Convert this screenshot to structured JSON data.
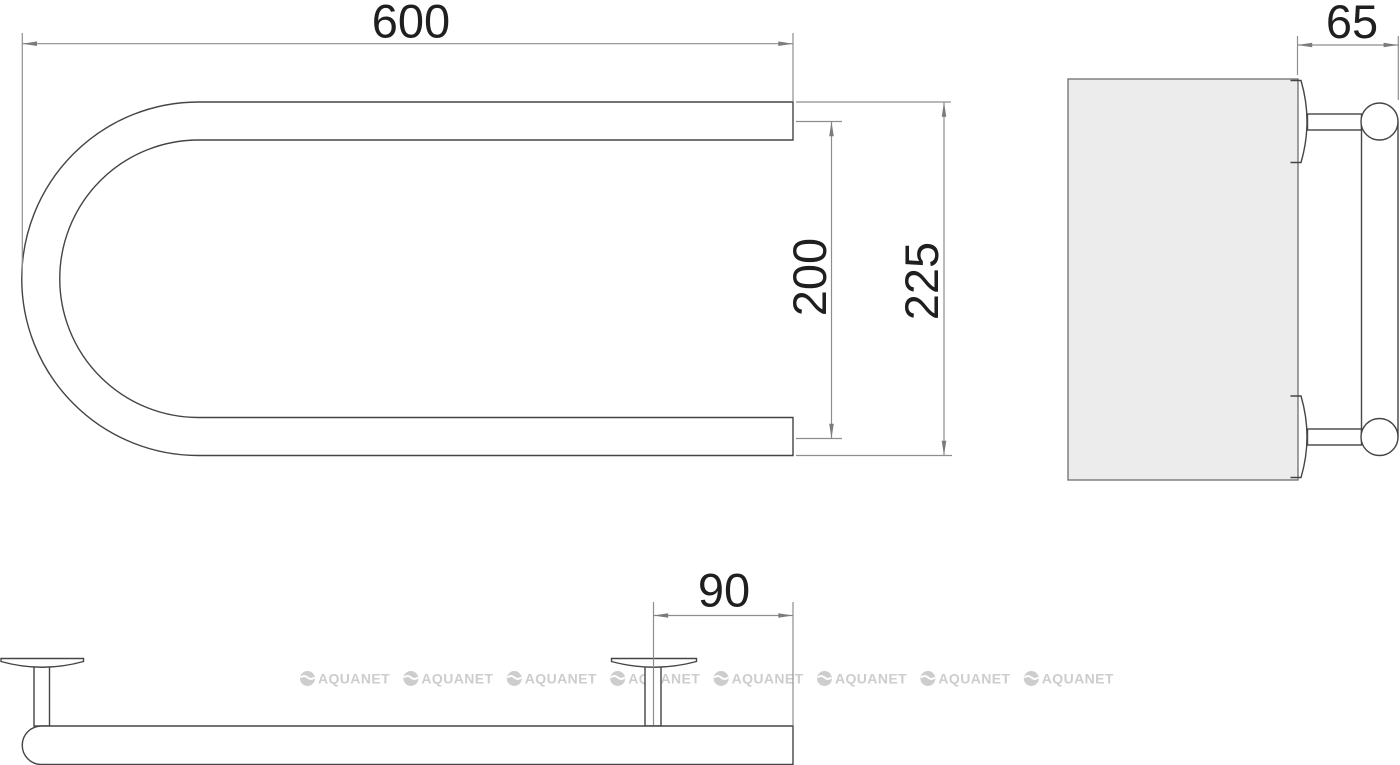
{
  "watermark": {
    "text": "AQUANET"
  },
  "dimensions": {
    "rail_length": "600",
    "tube_center_distance": "200",
    "overall_height": "225",
    "wall_offset": "65",
    "bracket_to_end": "90"
  },
  "colors": {
    "object_line": "#454545",
    "dimension_line": "#8e8e8e",
    "arrow": "#7b7b7b",
    "label_text": "#1f1f1f",
    "wall_fill": "#ececec",
    "watermark": "#cdcdcd",
    "background": "#ffffff"
  }
}
